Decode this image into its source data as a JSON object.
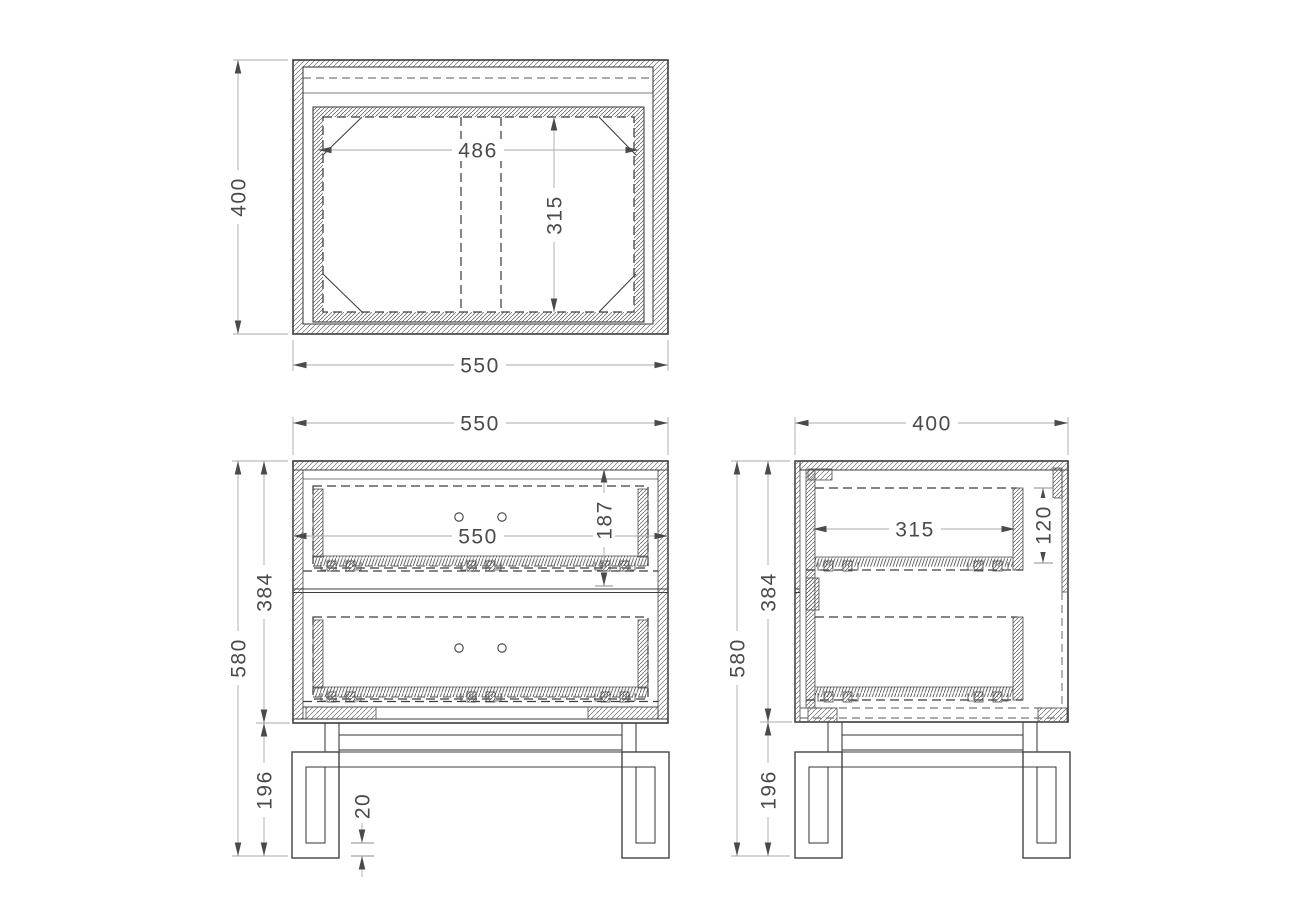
{
  "drawing": {
    "description": "Three-view technical drawing of a two-drawer nightstand on a metal frame base",
    "views": {
      "top": {
        "title": "top-view",
        "dims": {
          "height": "400",
          "width": "550",
          "inner_width": "486",
          "inner_depth": "315"
        }
      },
      "front": {
        "title": "front-view",
        "dims": {
          "width": "550",
          "inner_width": "550",
          "drawer_opening_height": "187",
          "carcass_height": "384",
          "total_height": "580",
          "leg_height": "196",
          "foot_thickness": "20"
        }
      },
      "side": {
        "title": "side-view",
        "dims": {
          "depth": "400",
          "inner_depth": "315",
          "drawer_opening_height": "120",
          "carcass_height": "384",
          "total_height": "580",
          "leg_height": "196"
        }
      }
    },
    "colors": {
      "background": "#ffffff",
      "line": "#3c3c3c",
      "dimension_line": "#a8a8a8",
      "text": "#4a4a4a"
    }
  }
}
